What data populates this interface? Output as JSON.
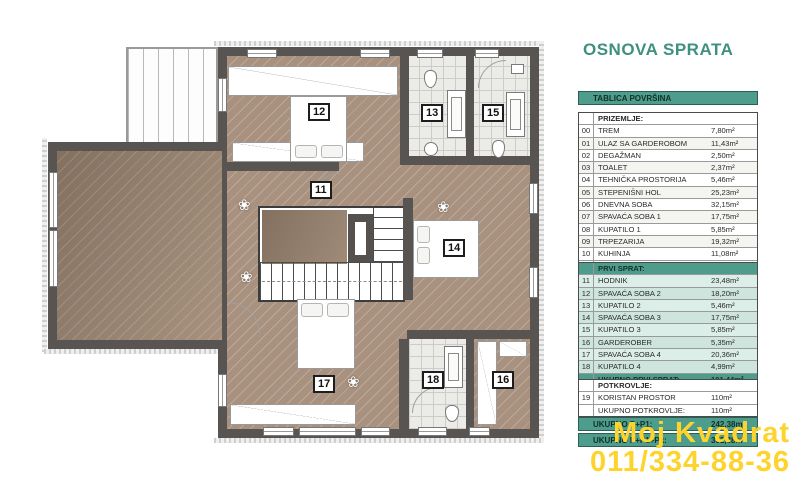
{
  "title": "OSNOVA SPRATA",
  "table": {
    "title": "TABLICA POVRŠINA",
    "prizemlje": {
      "header": "PRIZEMLJE:",
      "rows": [
        {
          "num": "00",
          "name": "TREM",
          "area": "7,80m²"
        },
        {
          "num": "01",
          "name": "ULAZ SA GARDEROBOM",
          "area": "11,43m²"
        },
        {
          "num": "02",
          "name": "DEGAŽMAN",
          "area": "2,50m²"
        },
        {
          "num": "03",
          "name": "TOALET",
          "area": "2,37m²"
        },
        {
          "num": "04",
          "name": "TEHNIČKA PROSTORIJA",
          "area": "5,46m²"
        },
        {
          "num": "05",
          "name": "STEPENIŠNI HOL",
          "area": "25,23m²"
        },
        {
          "num": "06",
          "name": "DNEVNA SOBA",
          "area": "32,15m²"
        },
        {
          "num": "07",
          "name": "SPAVAĆA SOBA 1",
          "area": "17,75m²"
        },
        {
          "num": "08",
          "name": "KUPATILO 1",
          "area": "5,85m²"
        },
        {
          "num": "09",
          "name": "TRPEZARIJA",
          "area": "19,32m²"
        },
        {
          "num": "10",
          "name": "KUHINJA",
          "area": "11,08m²"
        }
      ],
      "total_label": "UKUPNO PRIZEMLJE:",
      "total_value": "140,94m²"
    },
    "prvi_sprat": {
      "header": "PRVI SPRAT:",
      "rows": [
        {
          "num": "11",
          "name": "HODNIK",
          "area": "23,48m²"
        },
        {
          "num": "12",
          "name": "SPAVAĆA SOBA 2",
          "area": "18,20m²"
        },
        {
          "num": "13",
          "name": "KUPATILO 2",
          "area": "5,46m²"
        },
        {
          "num": "14",
          "name": "SPAVAĆA SOBA 3",
          "area": "17,75m²"
        },
        {
          "num": "15",
          "name": "KUPATILO 3",
          "area": "5,85m²"
        },
        {
          "num": "16",
          "name": "GARDEROBER",
          "area": "5,35m²"
        },
        {
          "num": "17",
          "name": "SPAVAĆA SOBA 4",
          "area": "20,36m²"
        },
        {
          "num": "18",
          "name": "KUPATILO 4",
          "area": "4,99m²"
        }
      ],
      "total_label": "UKUPNO PRVI SPRAT:",
      "total_value": "101,44m²"
    },
    "potkrovlje": {
      "header": "POTKROVLJE:",
      "rows": [
        {
          "num": "19",
          "name": "KORISTAN PROSTOR",
          "area": "110m²"
        }
      ],
      "total_label": "UKUPNO POTKROVLJE:",
      "total_value": "110m²"
    },
    "totals": [
      {
        "label": "UKUPNO P+P1:",
        "value": "242,38m²"
      },
      {
        "label": "UKUPNO P+P1+Pk:",
        "value": "352,38m²"
      }
    ]
  },
  "plan": {
    "labels": [
      "11",
      "12",
      "13",
      "14",
      "15",
      "16",
      "17",
      "18"
    ]
  },
  "watermark": {
    "line1": "Moj Kvadrat",
    "line2": "011/334-88-36"
  },
  "colors": {
    "teal": "#4d9c8c",
    "teal_light": "#dceee8",
    "title_teal": "#3f9080",
    "wall": "#585451",
    "floor_tan": "#a8917e",
    "watermark_yellow": "#fed32b"
  }
}
